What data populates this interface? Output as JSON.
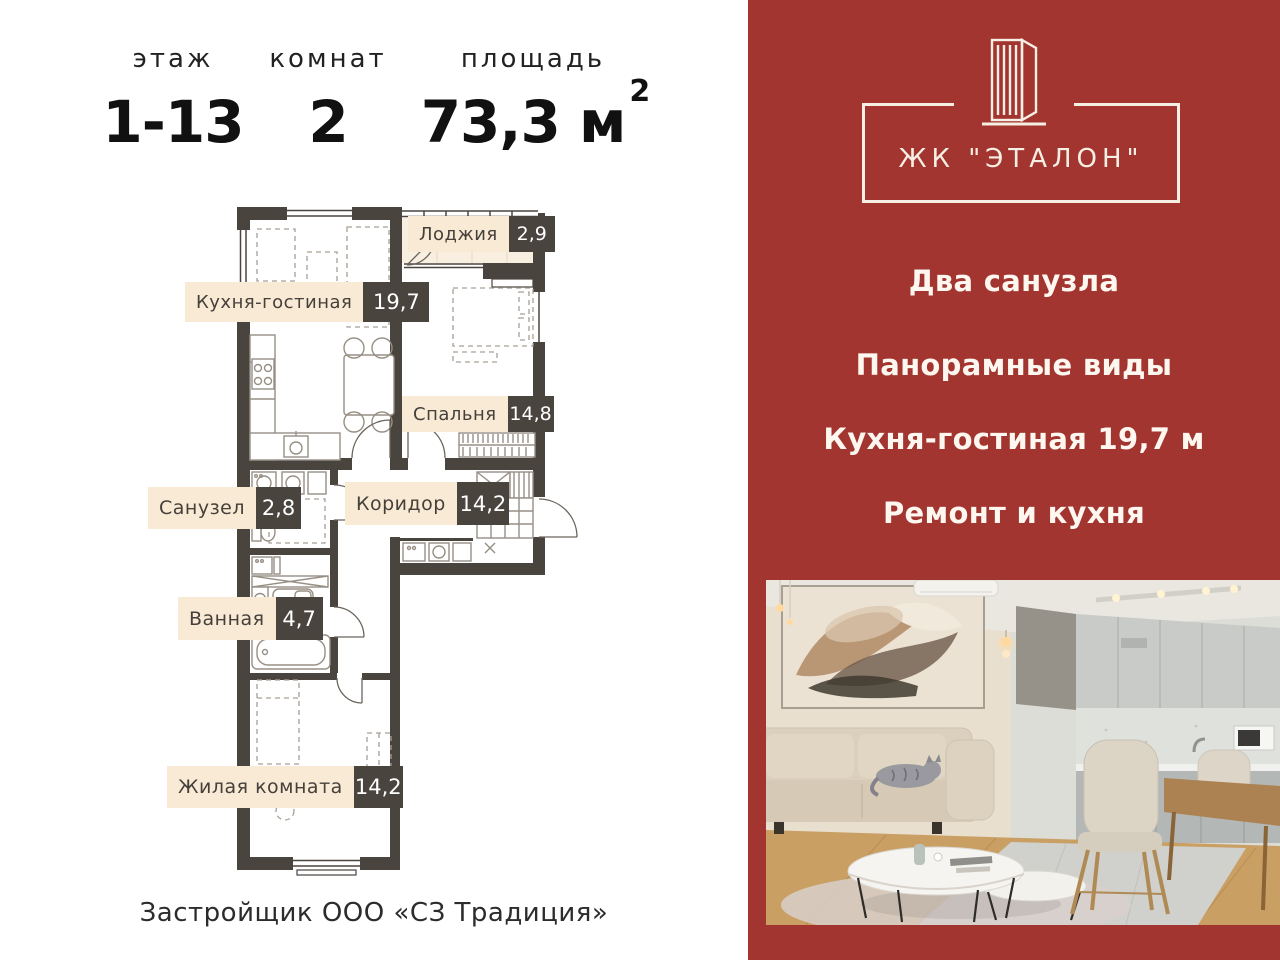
{
  "summary": {
    "columns": [
      {
        "label": "этаж",
        "value": "1-13"
      },
      {
        "label": "комнат",
        "value": "2"
      },
      {
        "label": "площадь",
        "value": "73,3 м",
        "sup": "2"
      }
    ]
  },
  "floor_plan": {
    "rooms": [
      {
        "name": "Кухня-гостиная",
        "area": "19,7"
      },
      {
        "name": "Лоджия",
        "area": "2,9"
      },
      {
        "name": "Спальня",
        "area": "14,8"
      },
      {
        "name": "Санузел",
        "area": "2,8"
      },
      {
        "name": "Коридор",
        "area": "14,2"
      },
      {
        "name": "Ванная",
        "area": "4,7"
      },
      {
        "name": "Жилая комната",
        "area": "14,2"
      }
    ]
  },
  "footer": {
    "developer": "Застройщик ООО «СЗ Традиция»"
  },
  "promo": {
    "logo_text": "ЖК \"ЭТАЛОН\"",
    "features": [
      {
        "text": "Два санузла"
      },
      {
        "text": "Панорамные виды"
      },
      {
        "text": "Кухня-гостиная 19,7 м"
      },
      {
        "text": "Ремонт и кухня"
      }
    ]
  },
  "colors": {
    "accent_red": "#a33531",
    "wall_dark": "#4a443e",
    "label_cream": "#f9ead6"
  }
}
